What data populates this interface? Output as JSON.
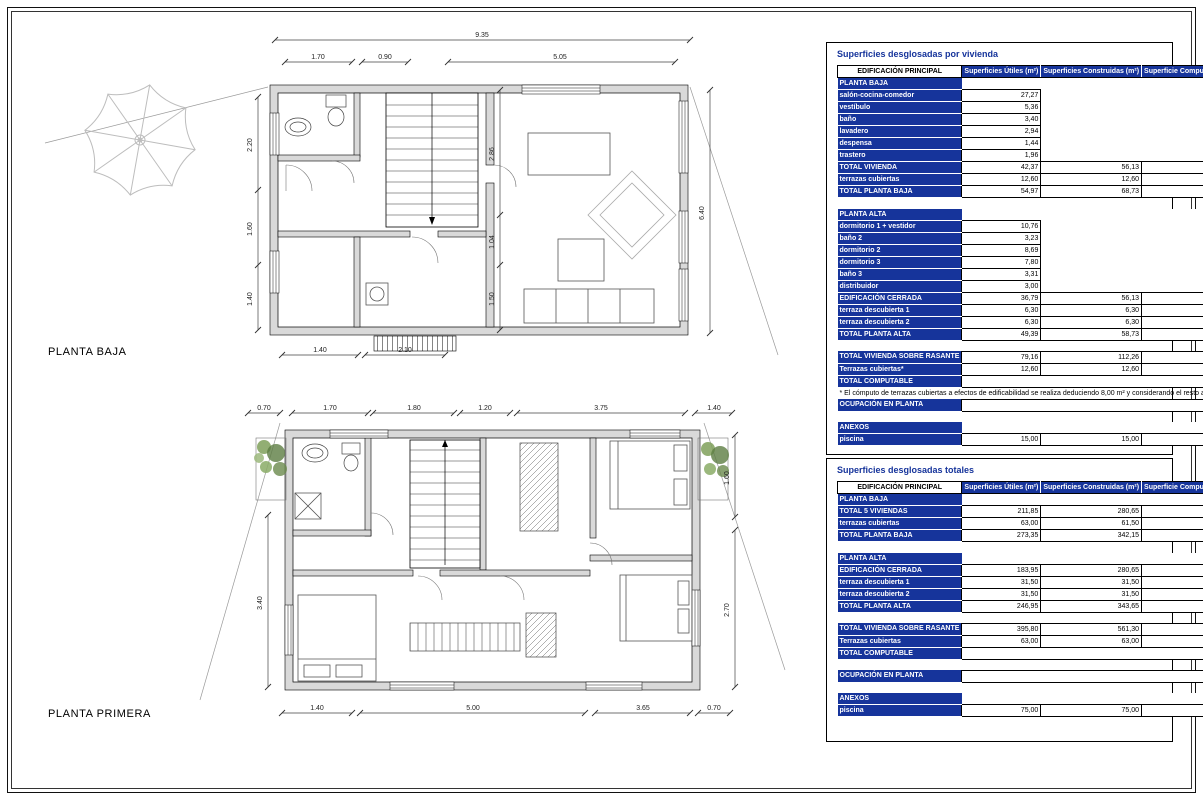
{
  "colors": {
    "header_blue": "#16349B",
    "wall_gray": "#D9D9D9"
  },
  "plans": [
    {
      "title": "PLANTA BAJA",
      "dims": {
        "overall_top": "9.35",
        "top": [
          "1.70",
          "0.90",
          "5.05"
        ],
        "left": [
          "2.20",
          "1.60",
          "1.40"
        ],
        "inner": [
          "2.86",
          "1.04",
          "1.50"
        ],
        "right": "6.40",
        "bottom": [
          "1.40",
          "2.10"
        ]
      }
    },
    {
      "title": "PLANTA PRIMERA",
      "dims": {
        "top": [
          "0.70",
          "1.70",
          "1.80",
          "1.20",
          "3.75",
          "1.40"
        ],
        "left": "3.40",
        "right": [
          "1.60",
          "2.70"
        ],
        "bottom": [
          "1.40",
          "5.00",
          "3.65",
          "0.70"
        ]
      }
    }
  ],
  "tables": [
    {
      "title": "Superficies desglosadas por vivienda",
      "col0_header": "EDIFICACIÓN PRINCIPAL",
      "headers": [
        "Superficies Útiles (m²)",
        "Superficies Construidas (m²)",
        "Superficie Computable (m²t)"
      ],
      "rows": [
        {
          "type": "section",
          "label": "PLANTA BAJA"
        },
        {
          "type": "item",
          "label": "salón-cocina-comedor",
          "v": [
            "27,27",
            "",
            ""
          ]
        },
        {
          "type": "item",
          "label": "vestíbulo",
          "v": [
            "5,36",
            "",
            ""
          ]
        },
        {
          "type": "item",
          "label": "baño",
          "v": [
            "3,40",
            "",
            ""
          ]
        },
        {
          "type": "item",
          "label": "lavadero",
          "v": [
            "2,94",
            "",
            ""
          ]
        },
        {
          "type": "item",
          "label": "despensa",
          "v": [
            "1,44",
            "",
            ""
          ]
        },
        {
          "type": "item",
          "label": "trastero",
          "v": [
            "1,96",
            "",
            ""
          ]
        },
        {
          "type": "total",
          "label": "TOTAL VIVIENDA",
          "v": [
            "42,37",
            "56,13",
            "56,13"
          ]
        },
        {
          "type": "item",
          "label": "terrazas cubiertas",
          "v": [
            "12,60",
            "12,60",
            "2,30"
          ]
        },
        {
          "type": "total",
          "label": "TOTAL PLANTA BAJA",
          "v": [
            "54,97",
            "68,73",
            "58,43"
          ]
        },
        {
          "type": "blank"
        },
        {
          "type": "section",
          "label": "PLANTA ALTA"
        },
        {
          "type": "item",
          "label": "dormitorio 1 + vestidor",
          "v": [
            "10,76",
            "",
            ""
          ]
        },
        {
          "type": "item",
          "label": "baño 2",
          "v": [
            "3,23",
            "",
            ""
          ]
        },
        {
          "type": "item",
          "label": "dormitorio 2",
          "v": [
            "8,69",
            "",
            ""
          ]
        },
        {
          "type": "item",
          "label": "dormitorio 3",
          "v": [
            "7,80",
            "",
            ""
          ]
        },
        {
          "type": "item",
          "label": "baño 3",
          "v": [
            "3,31",
            "",
            ""
          ]
        },
        {
          "type": "item",
          "label": "distribuidor",
          "v": [
            "3,00",
            "",
            ""
          ]
        },
        {
          "type": "total",
          "label": "EDIFICACIÓN CERRADA",
          "v": [
            "36,79",
            "56,13",
            "51,85"
          ]
        },
        {
          "type": "item",
          "label": "terraza descubierta 1",
          "v": [
            "6,30",
            "6,30",
            "0,00"
          ]
        },
        {
          "type": "item",
          "label": "terraza descubierta 2",
          "v": [
            "6,30",
            "6,30",
            "0,00"
          ]
        },
        {
          "type": "total",
          "label": "TOTAL PLANTA ALTA",
          "v": [
            "49,39",
            "58,73",
            "51,85"
          ]
        },
        {
          "type": "blank"
        },
        {
          "type": "total",
          "label": "TOTAL VIVIENDA SOBRE RASANTE",
          "v": [
            "79,16",
            "112,26",
            "107,98"
          ]
        },
        {
          "type": "item",
          "label": "Terrazas cubiertas*",
          "v": [
            "12,60",
            "12,60",
            "2,30"
          ]
        },
        {
          "type": "merged",
          "label": "TOTAL COMPUTABLE",
          "value": "110,28"
        },
        {
          "type": "note",
          "text": "* El cómputo de terrazas cubiertas a efectos de edificabilidad se realiza deduciendo 8,00 m² y considerando el resto al 50%"
        },
        {
          "type": "merged",
          "label": "OCUPACIÓN EN PLANTA",
          "value": "68,90"
        },
        {
          "type": "blank"
        },
        {
          "type": "section",
          "label": "ANEXOS"
        },
        {
          "type": "item",
          "label": "piscina",
          "v": [
            "15,00",
            "15,00",
            "0,00"
          ]
        }
      ]
    },
    {
      "title": "Superficies desglosadas totales",
      "col0_header": "EDIFICACIÓN PRINCIPAL",
      "headers": [
        "Superficies Útiles (m²)",
        "Superficies Construidas (m²)",
        "Superficie Computable (m²t)"
      ],
      "rows": [
        {
          "type": "section",
          "label": "PLANTA BAJA"
        },
        {
          "type": "total",
          "label": "TOTAL 5 VIVIENDAS",
          "v": [
            "211,85",
            "280,65",
            "280,65"
          ]
        },
        {
          "type": "item",
          "label": "terrazas cubiertas",
          "v": [
            "63,00",
            "61,50",
            "11,50"
          ]
        },
        {
          "type": "total",
          "label": "TOTAL PLANTA BAJA",
          "v": [
            "273,35",
            "342,15",
            "292,15"
          ]
        },
        {
          "type": "blank"
        },
        {
          "type": "section",
          "label": "PLANTA ALTA"
        },
        {
          "type": "total",
          "label": "EDIFICACIÓN CERRADA",
          "v": [
            "183,95",
            "280,65",
            "259,25"
          ]
        },
        {
          "type": "item",
          "label": "terraza descubierta 1",
          "v": [
            "31,50",
            "31,50",
            "0,00"
          ]
        },
        {
          "type": "item",
          "label": "terraza descubierta 2",
          "v": [
            "31,50",
            "31,50",
            "0,00"
          ]
        },
        {
          "type": "total",
          "label": "TOTAL PLANTA ALTA",
          "v": [
            "246,95",
            "343,65",
            "259,25"
          ]
        },
        {
          "type": "blank"
        },
        {
          "type": "total",
          "label": "TOTAL VIVIENDA SOBRE RASANTE",
          "v": [
            "395,80",
            "561,30",
            "539,90"
          ]
        },
        {
          "type": "item",
          "label": "Terrazas cubiertas",
          "v": [
            "63,00",
            "63,00",
            "11,50"
          ]
        },
        {
          "type": "merged",
          "label": "TOTAL COMPUTABLE",
          "value": "551,40"
        },
        {
          "type": "blank"
        },
        {
          "type": "merged",
          "label": "OCUPACIÓN EN PLANTA",
          "value": "344,50"
        },
        {
          "type": "blank"
        },
        {
          "type": "section",
          "label": "ANEXOS"
        },
        {
          "type": "item",
          "label": "piscina",
          "v": [
            "75,00",
            "75,00",
            "0,00"
          ]
        }
      ]
    }
  ]
}
